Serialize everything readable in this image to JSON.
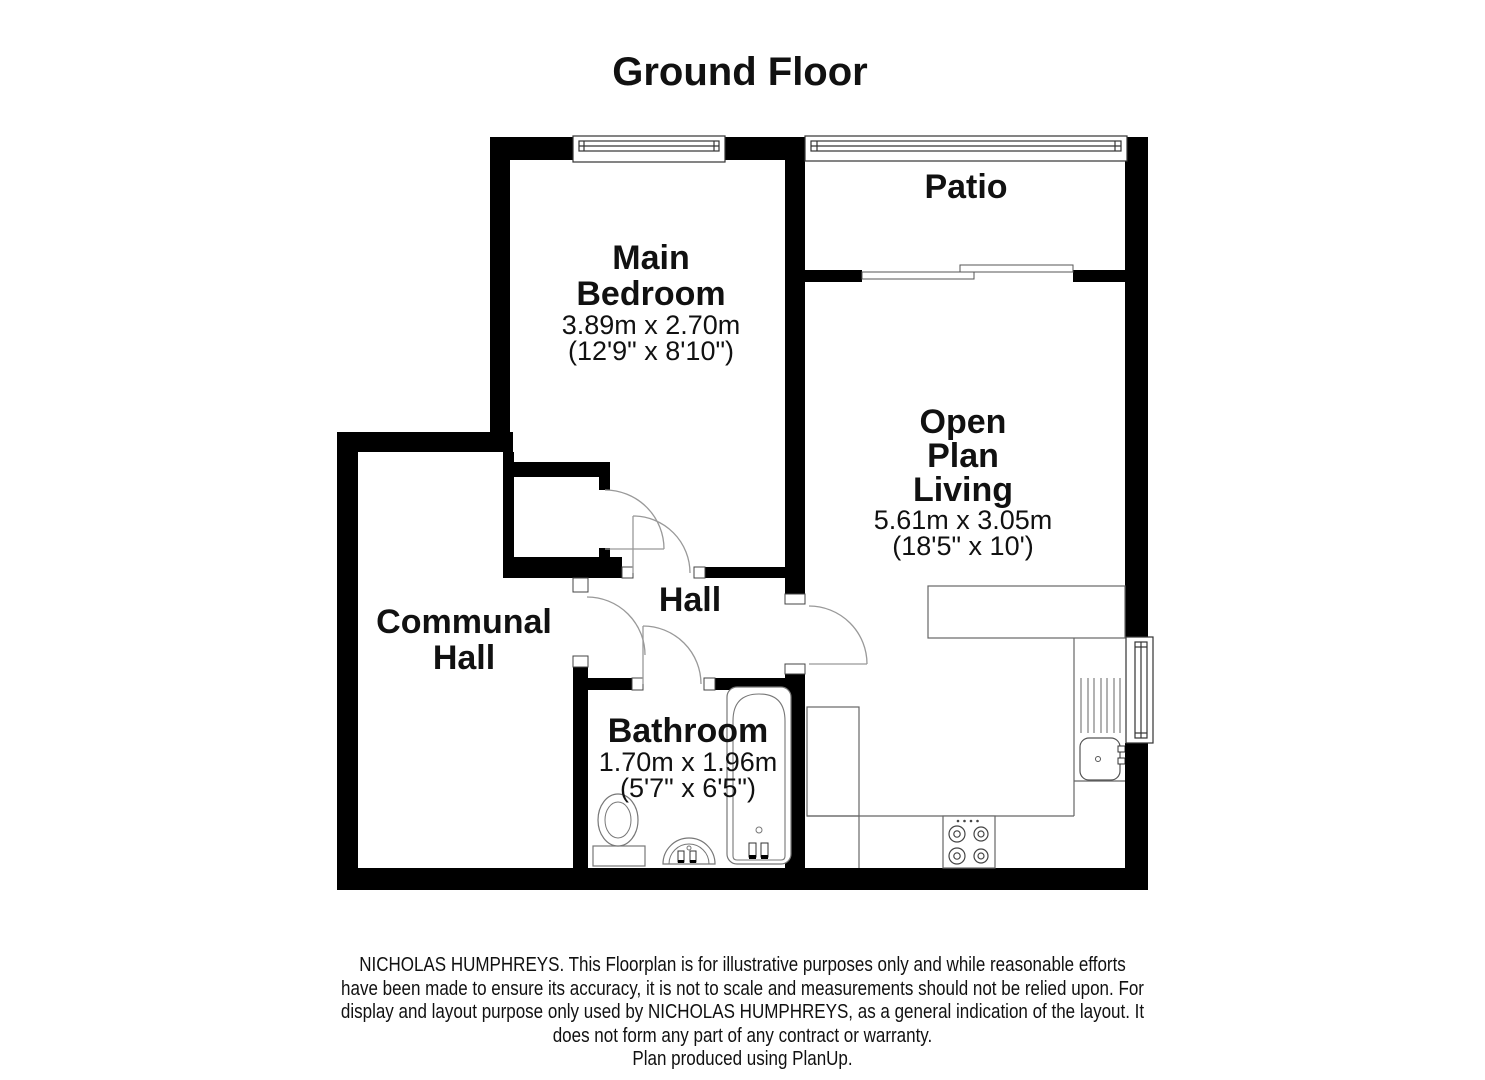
{
  "title": "Ground Floor",
  "rooms": {
    "patio": {
      "name": "Patio"
    },
    "main_bedroom": {
      "line1": "Main",
      "line2": "Bedroom",
      "metric": "3.89m x 2.70m",
      "imperial": "(12'9\" x 8'10\")"
    },
    "open_plan_living": {
      "line1": "Open",
      "line2": "Plan",
      "line3": "Living",
      "metric": "5.61m x 3.05m",
      "imperial": "(18'5\" x 10')"
    },
    "communal_hall": {
      "line1": "Communal",
      "line2": "Hall"
    },
    "hall": {
      "name": "Hall"
    },
    "bathroom": {
      "name": "Bathroom",
      "metric": "1.70m x 1.96m",
      "imperial": "(5'7\" x 6'5\")"
    }
  },
  "disclaimer": {
    "line1": "NICHOLAS HUMPHREYS. This Floorplan is for illustrative purposes only and while reasonable efforts",
    "line2": "have been made to ensure its accuracy, it is not to scale and measurements should not be relied upon. For",
    "line3": "display and layout purpose only used by NICHOLAS HUMPHREYS, as a general indication of the layout. It",
    "line4": "does not form any part of any contract or warranty.",
    "line5": "Plan produced using PlanUp."
  },
  "colors": {
    "wall": "#000000",
    "fixture_line": "#777777",
    "counter_line": "#666666",
    "door_arc": "#999999",
    "text": "#111111",
    "background": "#ffffff"
  }
}
